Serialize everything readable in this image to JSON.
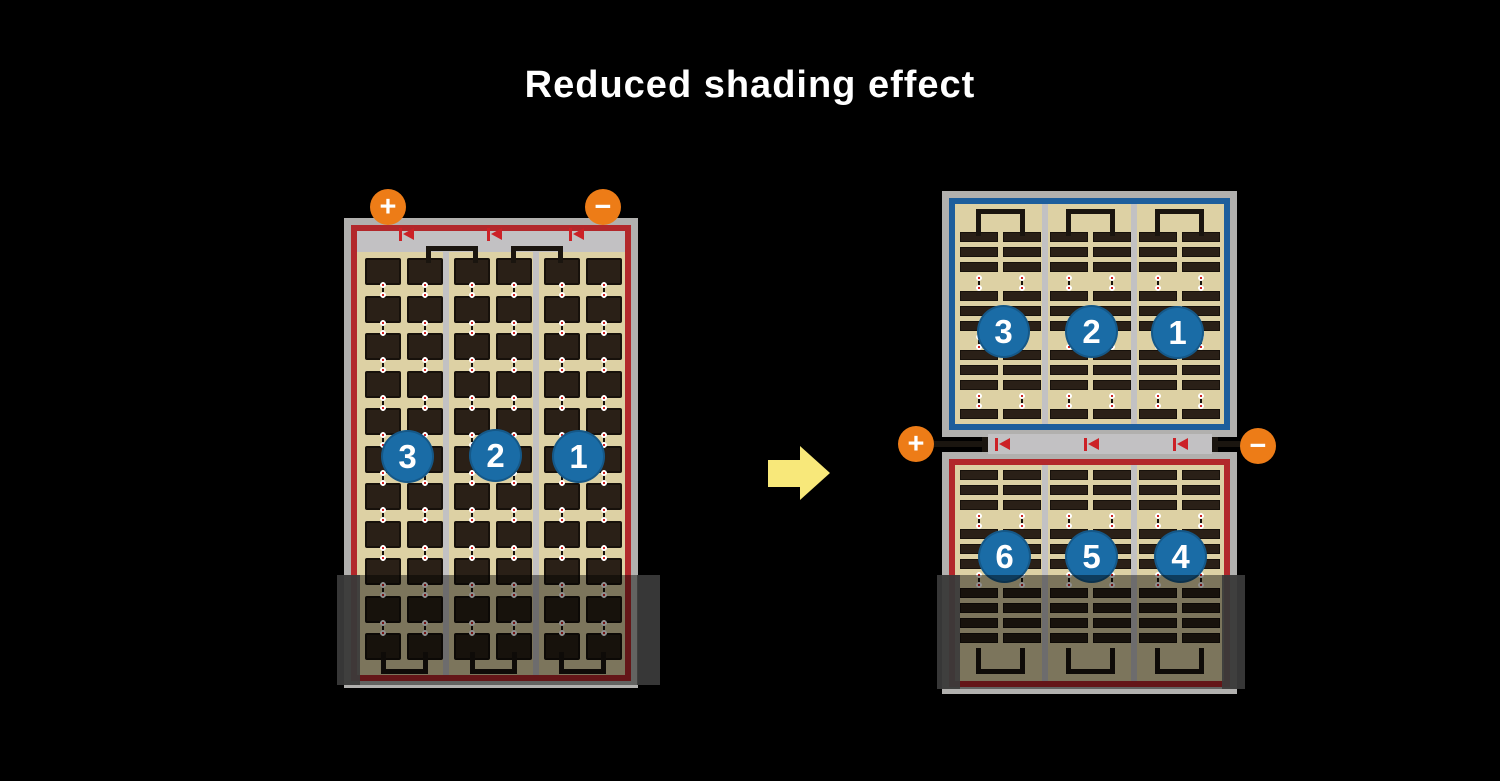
{
  "title": "Reduced shading effect",
  "colors": {
    "background": "#000000",
    "title_text": "#ffffff",
    "panel_frame": "#b1b0ae",
    "panel_cream": "#ddd1a4",
    "silver": "#c2c1c3",
    "cell_dark": "#2a2017",
    "cell_border": "#17110b",
    "red_border": "#b2282b",
    "diode_red": "#cc2127",
    "blue_border": "#1d5e9c",
    "badge_blue": "#1a6ca6",
    "badge_text": "#ffffff",
    "terminal_orange": "#ed7c17",
    "terminal_text": "#ffffff",
    "wire_black": "#1a150f",
    "arrow_yellow": "#f8e87a",
    "shade": "rgba(0,0,0,0.44)",
    "shade_end": "#3c3c3c",
    "dot_white": "#ffffff",
    "dot_red": "#cc1111"
  },
  "left_module": {
    "terminals": [
      {
        "symbol": "+"
      },
      {
        "symbol": "−"
      }
    ],
    "string_badges": [
      "3",
      "2",
      "1"
    ],
    "diode_count": 3,
    "shaded": true
  },
  "right_module": {
    "top_half": {
      "string_badges": [
        "3",
        "2",
        "1"
      ]
    },
    "bottom_half": {
      "string_badges": [
        "6",
        "5",
        "4"
      ]
    },
    "terminals": [
      {
        "symbol": "+"
      },
      {
        "symbol": "−"
      }
    ],
    "diode_count": 3,
    "shaded": true
  },
  "arrow": {
    "direction": "right"
  }
}
